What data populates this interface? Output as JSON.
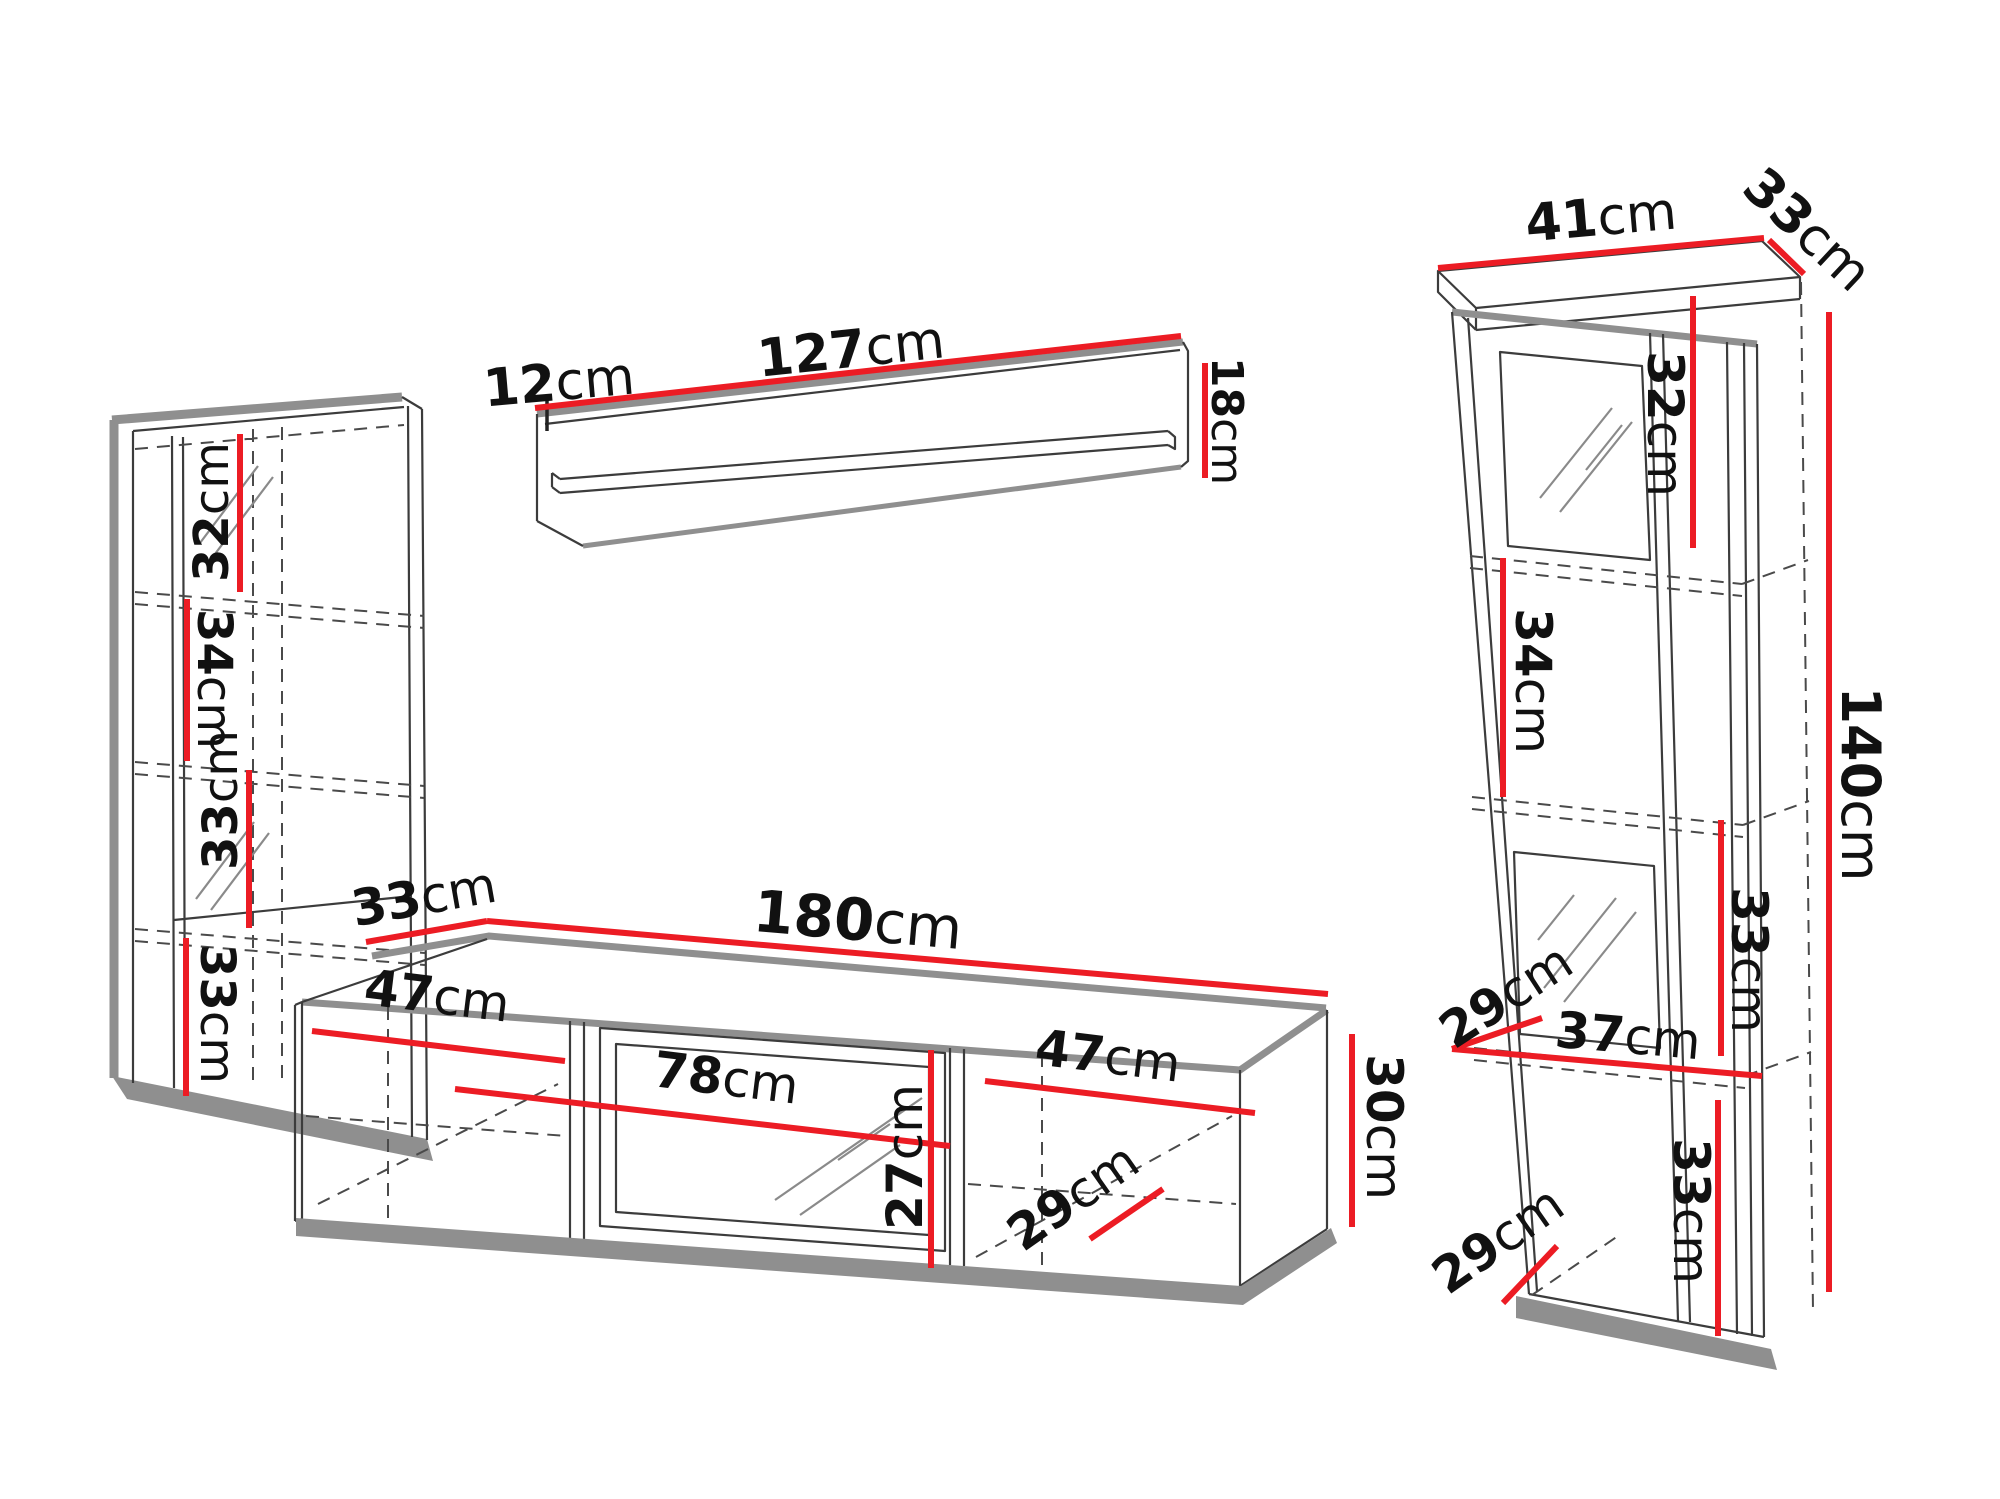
{
  "diagram": {
    "type": "furniture-wall-unit-dimension-diagram",
    "unit": "cm",
    "colors": {
      "dimension_red": "#ec1c24",
      "edge_gray": "#8f8f8f",
      "sketch_dark": "#3c3c3c",
      "background": "#ffffff",
      "text": "#111111"
    },
    "left_cabinet": {
      "section_heights": [
        "32",
        "34",
        "33",
        "33"
      ]
    },
    "wall_shelf": {
      "end_depth": "12",
      "width": "127",
      "end_height": "18"
    },
    "tv_stand": {
      "depth": "33",
      "width": "180",
      "left_compartment_width": "47",
      "glass_door_width": "78",
      "inner_height": "27",
      "right_compartment_width": "47",
      "inner_depth": "29",
      "height": "30"
    },
    "right_cabinet": {
      "top_width": "41",
      "top_depth": "33",
      "section1_height": "32",
      "section2_height": "34",
      "total_height": "140",
      "section3_height": "33",
      "shelf_depth_upper": "29",
      "inner_width": "37",
      "shelf_depth_lower": "29",
      "section4_height": "33"
    }
  }
}
